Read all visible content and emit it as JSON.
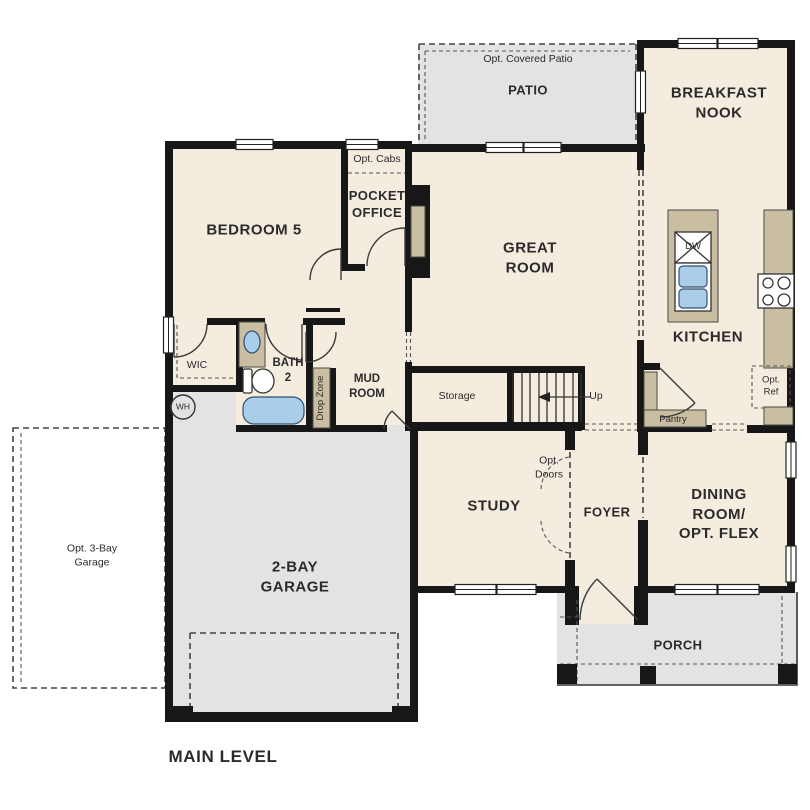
{
  "plan_title": "MAIN LEVEL",
  "colors": {
    "floor": "#f4ecdf",
    "optional_area_gray": "#e3e3e1",
    "cabinet_tan": "#c9bda2",
    "fixture_blue": "#aacdea",
    "wall_black": "#171717",
    "background": "#ffffff"
  },
  "rooms": {
    "patio": {
      "label": "PATIO",
      "optional_note": "Opt. Covered Patio"
    },
    "breakfast_nook": {
      "label": "BREAKFAST\nNOOK"
    },
    "kitchen": {
      "label": "KITCHEN",
      "island_appliance": "DW",
      "optional_fridge": "Opt.\nRef",
      "pantry": "Pantry"
    },
    "great_room": {
      "label": "GREAT\nROOM"
    },
    "pocket_office": {
      "label": "POCKET\nOFFICE",
      "optional_note": "Opt. Cabs"
    },
    "bedroom5": {
      "label": "BEDROOM 5"
    },
    "wic": {
      "label": "WIC"
    },
    "bath2": {
      "label": "BATH\n2"
    },
    "mud_room": {
      "label": "MUD\nROOM"
    },
    "drop_zone": {
      "label": "Drop Zone"
    },
    "storage": {
      "label": "Storage"
    },
    "stairs": {
      "label": "Up"
    },
    "study": {
      "label": "STUDY"
    },
    "foyer": {
      "label": "FOYER",
      "optional_doors": "Opt.\nDoors"
    },
    "dining_flex": {
      "label": "DINING ROOM/\nOPT. FLEX"
    },
    "porch": {
      "label": "PORCH"
    },
    "garage": {
      "label": "2-BAY\nGARAGE",
      "optional_note": "Opt. 3-Bay\nGarage",
      "water_heater": "WH"
    }
  }
}
